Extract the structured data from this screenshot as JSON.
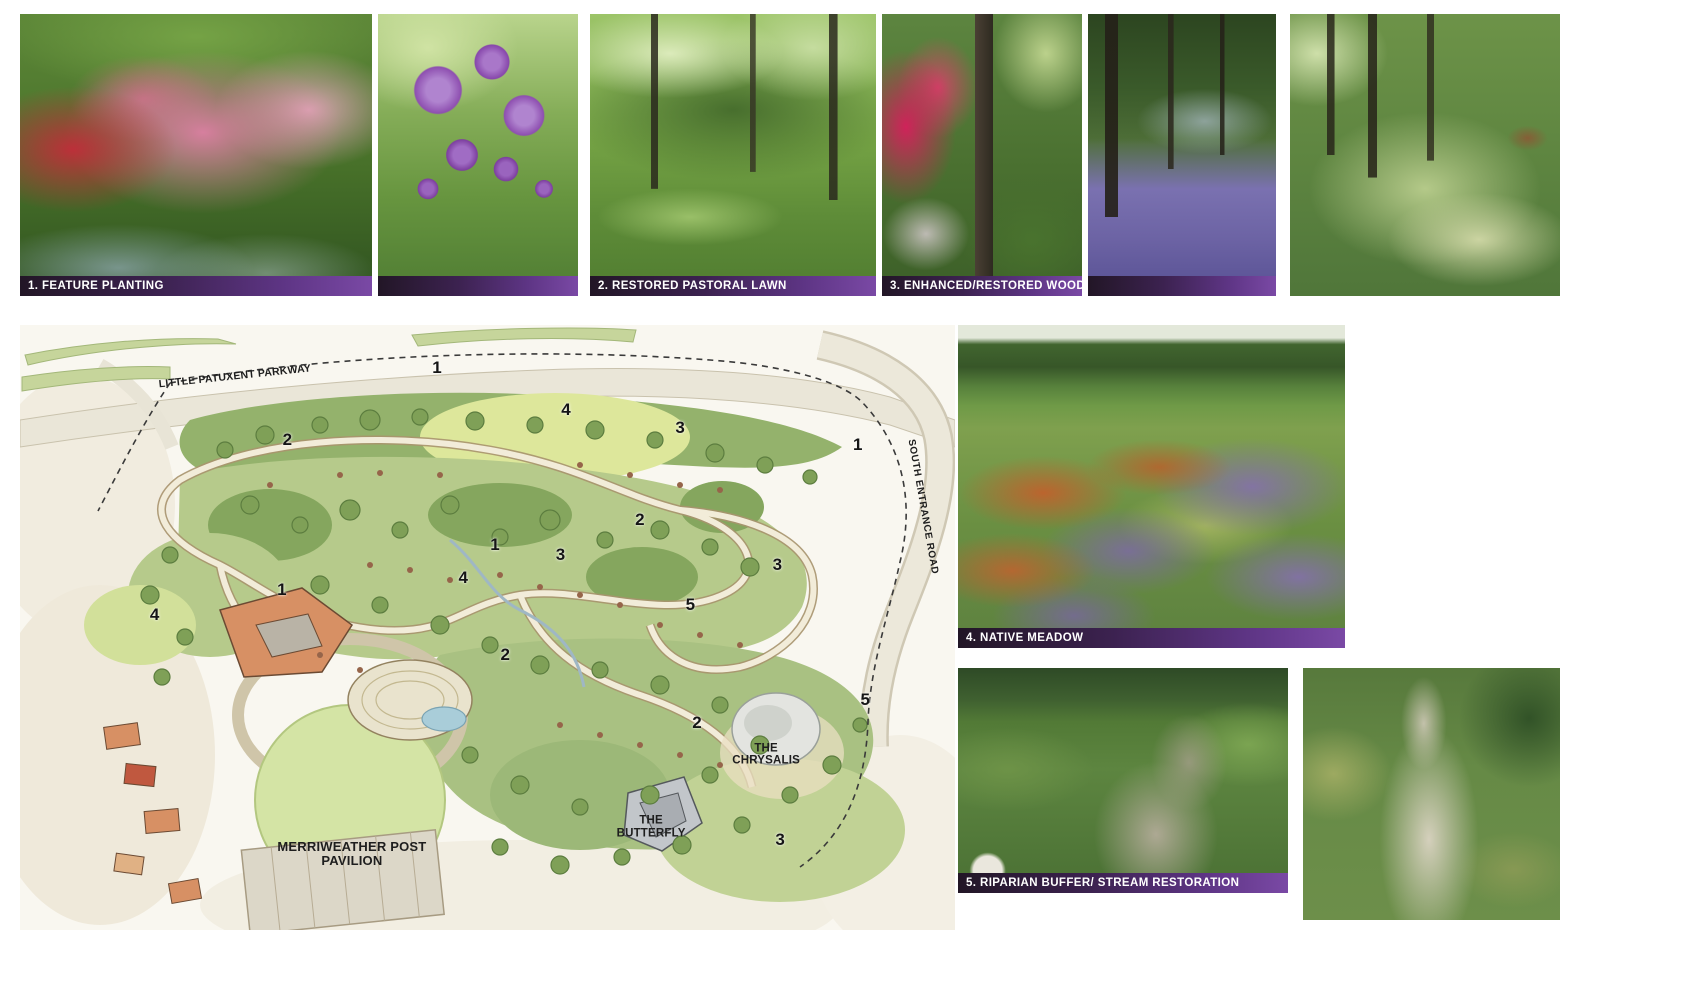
{
  "board_title": "planting typologies presentation board",
  "colors": {
    "caption_bar_start": "#221626",
    "caption_bar_end": "#7a49a5",
    "caption_text": "#ffffff",
    "plan_background": "#f9f7f0"
  },
  "photos": {
    "feature_planting": {
      "caption": "1. FEATURE PLANTING"
    },
    "allium": {
      "caption": ""
    },
    "pastoral_lawn": {
      "caption": "2. RESTORED PASTORAL LAWN"
    },
    "woodland": {
      "caption": "3. ENHANCED/RESTORED WOODLAND"
    },
    "bluebell": {
      "caption": ""
    },
    "fern_woodland": {
      "caption": ""
    },
    "native_meadow": {
      "caption": "4. NATIVE MEADOW"
    },
    "riparian": {
      "caption": "5. RIPARIAN BUFFER/ STREAM RESTORATION"
    },
    "stream_restoration": {
      "caption": ""
    }
  },
  "plan": {
    "labels": {
      "parkway": "LITTLE PATUXENT PARKWAY",
      "entrance_road": "SOUTH ENTRANCE ROAD",
      "pavilion": "MERRIWEATHER POST PAVILION",
      "butterfly": "THE BUTTERFLY",
      "chrysalis": "THE CHRYSALIS"
    },
    "zone_markers": [
      {
        "label": "1",
        "x": 44.6,
        "y": 7.1
      },
      {
        "label": "4",
        "x": 58.4,
        "y": 14.0
      },
      {
        "label": "3",
        "x": 70.6,
        "y": 17.0
      },
      {
        "label": "1",
        "x": 89.6,
        "y": 19.8
      },
      {
        "label": "2",
        "x": 28.6,
        "y": 19.0
      },
      {
        "label": "2",
        "x": 66.3,
        "y": 32.2
      },
      {
        "label": "1",
        "x": 50.8,
        "y": 36.4
      },
      {
        "label": "3",
        "x": 57.8,
        "y": 38.0
      },
      {
        "label": "3",
        "x": 81.0,
        "y": 39.7
      },
      {
        "label": "4",
        "x": 47.4,
        "y": 41.8
      },
      {
        "label": "1",
        "x": 28.0,
        "y": 43.8
      },
      {
        "label": "5",
        "x": 71.7,
        "y": 46.3
      },
      {
        "label": "4",
        "x": 14.4,
        "y": 47.9
      },
      {
        "label": "2",
        "x": 51.9,
        "y": 54.5
      },
      {
        "label": "2",
        "x": 72.4,
        "y": 65.8
      },
      {
        "label": "5",
        "x": 90.4,
        "y": 62.0
      },
      {
        "label": "3",
        "x": 81.3,
        "y": 85.1
      }
    ]
  }
}
